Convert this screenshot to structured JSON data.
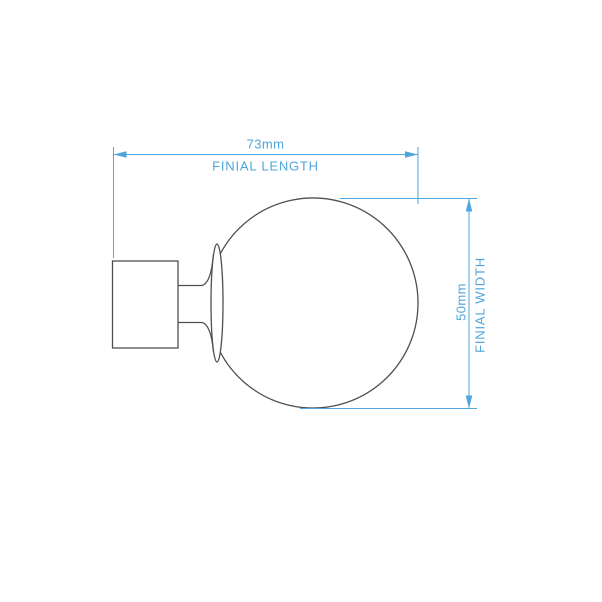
{
  "colors": {
    "dimension_blue": "#4fa5de",
    "drawing_gray": "#4b5054",
    "background": "#ffffff"
  },
  "dimensions": {
    "length": {
      "value": "73mm",
      "label": "FINIAL LENGTH"
    },
    "width": {
      "value": "50mm",
      "label": "FINIAL WIDTH"
    }
  }
}
